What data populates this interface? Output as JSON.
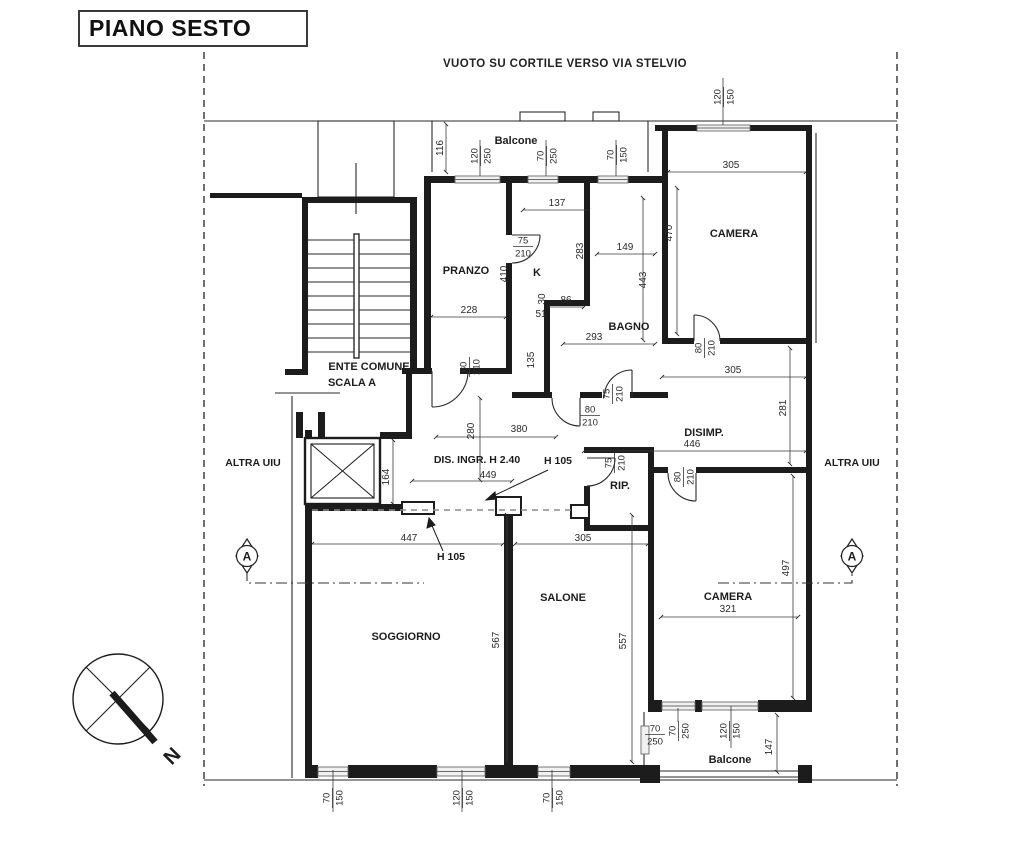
{
  "title": "PIANO SESTO",
  "top_label": "VUOTO SU CORTILE VERSO VIA STELVIO",
  "compass": {
    "north_label": "N"
  },
  "section_markers": [
    {
      "label": "A",
      "x": 247,
      "y": 556
    },
    {
      "label": "A",
      "x": 852,
      "y": 556
    }
  ],
  "room_labels": [
    {
      "text": "PRANZO",
      "x": 466,
      "y": 274
    },
    {
      "text": "K",
      "x": 537,
      "y": 276
    },
    {
      "text": "BAGNO",
      "x": 629,
      "y": 330
    },
    {
      "text": "CAMERA",
      "x": 734,
      "y": 237
    },
    {
      "text": "DISIMP.",
      "x": 704,
      "y": 436
    },
    {
      "text": "RIP.",
      "x": 620,
      "y": 489
    },
    {
      "text": "SOGGIORNO",
      "x": 406,
      "y": 640
    },
    {
      "text": "SALONE",
      "x": 563,
      "y": 601
    },
    {
      "text": "CAMERA",
      "x": 728,
      "y": 600
    },
    {
      "text": "Balcone",
      "x": 516,
      "y": 144
    },
    {
      "text": "Balcone",
      "x": 730,
      "y": 763
    },
    {
      "text": "ENTE COMUNE",
      "x": 369,
      "y": 370
    },
    {
      "text": "SCALA A",
      "x": 352,
      "y": 386
    }
  ],
  "annotation_labels": [
    {
      "text": "DIS. INGR. H 2.40",
      "x": 477,
      "y": 463
    },
    {
      "text": "H 105",
      "x": 558,
      "y": 464
    },
    {
      "text": "H 105",
      "x": 451,
      "y": 560
    },
    {
      "text": "ALTRA UIU",
      "x": 253,
      "y": 466
    },
    {
      "text": "ALTRA UIU",
      "x": 852,
      "y": 466
    }
  ],
  "dimension_labels": [
    {
      "t": "116",
      "x": 443,
      "y": 148,
      "r": -90
    },
    {
      "t": "305",
      "x": 731,
      "y": 168,
      "r": 0
    },
    {
      "t": "470",
      "x": 672,
      "y": 233,
      "r": -90
    },
    {
      "t": "443",
      "x": 646,
      "y": 280,
      "r": -90
    },
    {
      "t": "137",
      "x": 557,
      "y": 206,
      "r": 0
    },
    {
      "t": "149",
      "x": 625,
      "y": 250,
      "r": 0
    },
    {
      "t": "283",
      "x": 583,
      "y": 251,
      "r": -90
    },
    {
      "t": "410",
      "x": 507,
      "y": 274,
      "r": -90
    },
    {
      "t": "228",
      "x": 469,
      "y": 313,
      "r": 0
    },
    {
      "t": "30",
      "x": 545,
      "y": 299,
      "r": -90
    },
    {
      "t": "86",
      "x": 566,
      "y": 303,
      "r": 0
    },
    {
      "t": "51",
      "x": 541,
      "y": 317,
      "r": 0
    },
    {
      "t": "293",
      "x": 594,
      "y": 340,
      "r": 0
    },
    {
      "t": "135",
      "x": 534,
      "y": 360,
      "r": -90
    },
    {
      "t": "305",
      "x": 733,
      "y": 373,
      "r": 0
    },
    {
      "t": "281",
      "x": 786,
      "y": 408,
      "r": -90
    },
    {
      "t": "380",
      "x": 519,
      "y": 432,
      "r": 0
    },
    {
      "t": "280",
      "x": 474,
      "y": 431,
      "r": -90
    },
    {
      "t": "446",
      "x": 692,
      "y": 447,
      "r": 0
    },
    {
      "t": "449",
      "x": 488,
      "y": 478,
      "r": 0
    },
    {
      "t": "164",
      "x": 389,
      "y": 477,
      "r": -90
    },
    {
      "t": "447",
      "x": 409,
      "y": 541,
      "r": 0
    },
    {
      "t": "305",
      "x": 583,
      "y": 541,
      "r": 0
    },
    {
      "t": "321",
      "x": 728,
      "y": 612,
      "r": 0
    },
    {
      "t": "567",
      "x": 499,
      "y": 640,
      "r": -90
    },
    {
      "t": "557",
      "x": 626,
      "y": 641,
      "r": -90
    },
    {
      "t": "497",
      "x": 789,
      "y": 568,
      "r": -90
    },
    {
      "t": "147",
      "x": 772,
      "y": 747,
      "r": -90
    }
  ],
  "size_labels": [
    {
      "a": "120",
      "b": "250",
      "x": 480,
      "y": 156,
      "r": -90
    },
    {
      "a": "70",
      "b": "250",
      "x": 546,
      "y": 156,
      "r": -90
    },
    {
      "a": "70",
      "b": "150",
      "x": 616,
      "y": 155,
      "r": -90
    },
    {
      "a": "120",
      "b": "150",
      "x": 723,
      "y": 97,
      "r": -90
    },
    {
      "a": "75",
      "b": "210",
      "x": 523,
      "y": 246,
      "r": 0
    },
    {
      "a": "80",
      "b": "210",
      "x": 469,
      "y": 367,
      "r": -90
    },
    {
      "a": "75",
      "b": "210",
      "x": 612,
      "y": 394,
      "r": -90
    },
    {
      "a": "80",
      "b": "210",
      "x": 704,
      "y": 348,
      "r": -90
    },
    {
      "a": "80",
      "b": "210",
      "x": 590,
      "y": 415,
      "r": 0
    },
    {
      "a": "75",
      "b": "210",
      "x": 614,
      "y": 463,
      "r": -90
    },
    {
      "a": "80",
      "b": "210",
      "x": 683,
      "y": 477,
      "r": -90
    },
    {
      "a": "70",
      "b": "250",
      "x": 655,
      "y": 734,
      "r": 0
    },
    {
      "a": "70",
      "b": "250",
      "x": 678,
      "y": 731,
      "r": -90
    },
    {
      "a": "120",
      "b": "150",
      "x": 729,
      "y": 731,
      "r": -90
    },
    {
      "a": "70",
      "b": "150",
      "x": 332,
      "y": 798,
      "r": -90
    },
    {
      "a": "120",
      "b": "150",
      "x": 462,
      "y": 798,
      "r": -90
    },
    {
      "a": "70",
      "b": "150",
      "x": 552,
      "y": 798,
      "r": -90
    }
  ]
}
